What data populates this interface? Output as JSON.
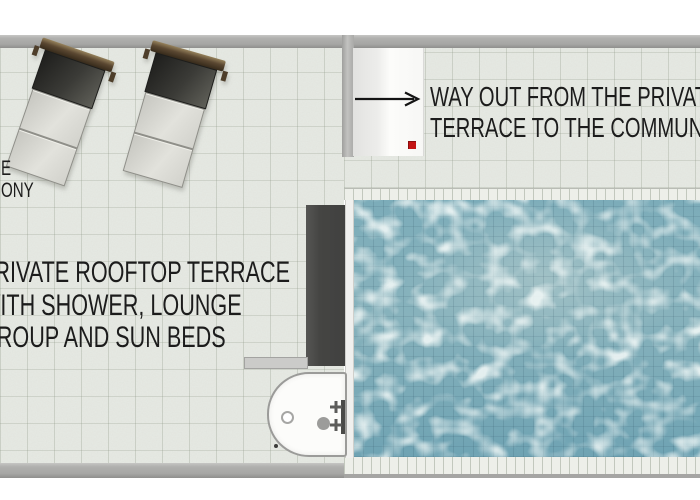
{
  "labels": {
    "balcony_partial": {
      "line1": "E",
      "line2": "ONY"
    },
    "terrace": {
      "line1": "PRIVATE ROOFTOP TERRACE",
      "line2": "WITH SHOWER, LOUNGE",
      "line3": "GROUP AND SUN BEDS"
    },
    "way_out": {
      "line1": "WAY OUT FROM THE PRIVATE",
      "line2": "TERRACE TO THE COMMUNAL"
    }
  },
  "colors": {
    "floor_tile": "#e5e8e2",
    "wall_gray": "#a6a6a4",
    "dark_wall": "#454543",
    "pool_water": "#7cacb9",
    "pool_caustic": "#dde9e7",
    "coping_tile": "#edefe9",
    "door_white": "#fcfcfa",
    "exit_marker_red": "#c41414",
    "text": "#1c1c1c",
    "lounger_frame_brown": "#5a4731",
    "lounger_backrest": "#3b3b37",
    "lounger_cushion": "#d7d7d1"
  },
  "objects": {
    "sun_loungers_count": 2,
    "pool": "swimming-pool",
    "shower": "shower-tray",
    "exit": "door-with-arrow"
  }
}
